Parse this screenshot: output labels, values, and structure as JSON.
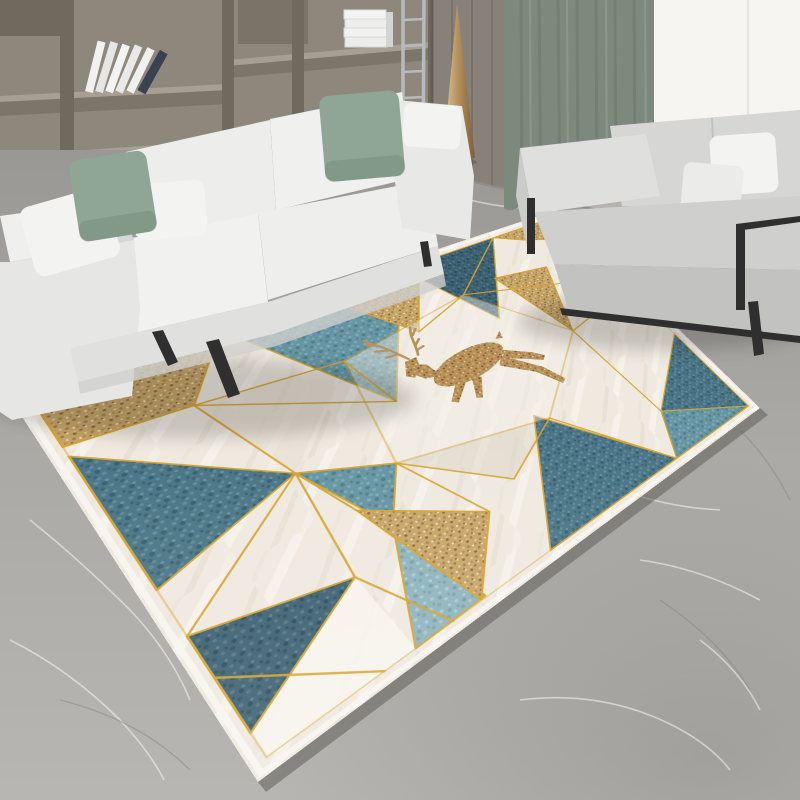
{
  "scene": {
    "type": "product-photo",
    "subject": "geometric deer rug in modern living room",
    "objects": [
      "bookshelf",
      "books",
      "wall-panels",
      "curtain",
      "window",
      "floor-lamp",
      "ladder-rack",
      "sofa-left",
      "sofa-right",
      "pillows",
      "marble-floor",
      "geometric-rug",
      "deer-motif"
    ]
  },
  "palette": {
    "wall_wood": "#8e887c",
    "wall_wood_dark": "#6f695e",
    "wall_wood_light": "#a69f93",
    "wall_panel": "#87817a",
    "curtain": "#7e897e",
    "curtain_dark": "#65706a",
    "window": "#f6f5f2",
    "sofa_white": "#edeeec",
    "sofa_seat": "#f1f1ef",
    "sofa_front": "#e0e1df",
    "sofa_arm": "#e8e9e7",
    "sofa_arm_side": "#d6d7d5",
    "sofa2_back": "#d6d6d4",
    "sofa2_seat": "#cfcfcd",
    "sofa2_front": "#c2c2c0",
    "sofa2_arm": "#dfdfdd",
    "pillow_green": "#8fa694",
    "pillow_green_dark": "#79907e",
    "pillow_white": "#f3f3f1",
    "metal": "#2f2f2f",
    "chrome": "#b7bbbc",
    "lamp_gold": "#c3a070",
    "floor_light": "#b9b7b3",
    "floor_mid": "#a8a6a2",
    "floor_dark": "#8f8d88",
    "rug_cream": "#efe9e0",
    "rug_white": "#f7f4ee",
    "teal_dark": "#4a7586",
    "teal_med": "#6695a3",
    "teal_light": "#8fb4bd",
    "teal_deep": "#3c6172",
    "glitter": "#c7a569",
    "glitter_dark": "#b8925a",
    "gold": "#d7a42c"
  },
  "rug": {
    "local_width": 740,
    "local_height": 520,
    "corners": {
      "left": [
        6,
        392
      ],
      "top": [
        556,
        210
      ],
      "right": [
        760,
        408
      ],
      "bottom": [
        258,
        782
      ]
    }
  }
}
